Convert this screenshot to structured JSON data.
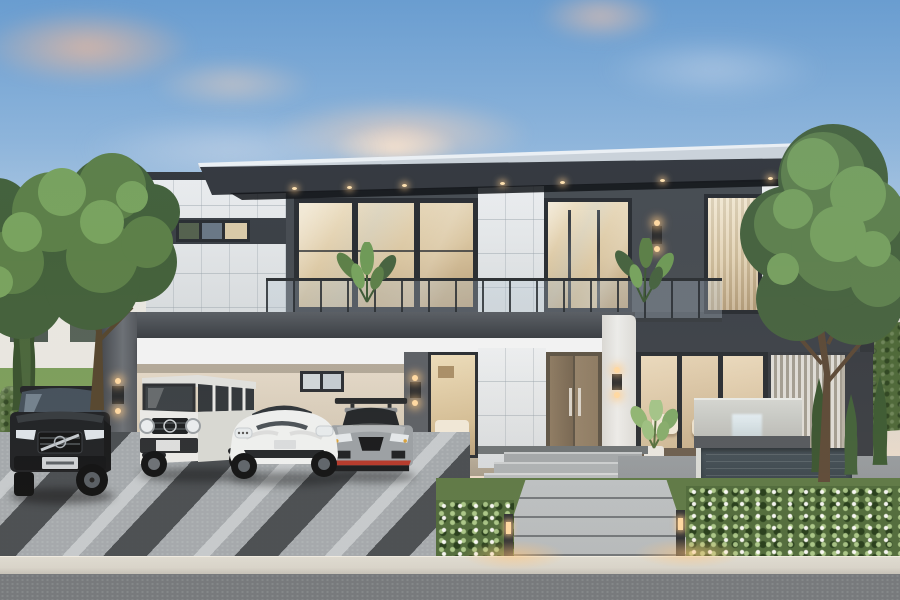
{
  "scene": {
    "setting": "Exterior rendering of a modern flat-roof two-storey luxury house at dusk",
    "elements": [
      "dusk sky with pink clouds",
      "large leafy trees flanking the house",
      "cantilevered dark roof with recessed soffit downlights",
      "white marble-tile feature tower with slot window",
      "full-height warm-lit windows and glass balcony with plants",
      "carport with dark frame and white beam",
      "wooden double entry door with steel pull handles",
      "glazed living room with cream sofas",
      "stone water-feature wall with reflecting pool",
      "clipped hedges, conical shrubs and raised lawn",
      "driveway with diagonal charcoal stripes",
      "stone paver walkway with bollard lights",
      "flower beds with white blossoms",
      "street strip in the foreground"
    ],
    "cars": [
      {
        "name": "black-luxury-suv",
        "body_color": "#1f2226"
      },
      {
        "name": "white-boxy-offroad-suv",
        "body_color": "#e9eae8"
      },
      {
        "name": "white-electric-sports-sedan",
        "body_color": "#eef0f0"
      },
      {
        "name": "grey-sports-coupe",
        "body_color": "#9aa0a5",
        "accent_color": "#b5382b"
      }
    ],
    "lighting": [
      "warm interior glow in every window",
      "soffit downlights under roof",
      "up/down wall sconces on pillars",
      "warm bollard path lights with glow pools on curb"
    ]
  },
  "palette": {
    "sky-top": "#6b9fd2",
    "sky-low": "#d2d4cf",
    "sky-horizon": "#eedccb",
    "cloud-pink": "#e8bca2",
    "cloud-cream": "#f4ddc6",
    "roof-metal": "#cdd4db",
    "roof-fascia": "#35393f",
    "soffit": "#24272c",
    "wall-dark": "#484d53",
    "wall-dark2": "#3e434a",
    "frame": "#2b2f34",
    "marble": "#e3e6e8",
    "warm-hi": "#f0e3c8",
    "warm-mid": "#d9c5a0",
    "warm-lo": "#b89e78",
    "beam-white": "#f2f3f4",
    "int-wall": "#e3d9c9",
    "int-wall2": "#c0b5a2",
    "door-wood": "#8d7b63",
    "door-wood2": "#776753",
    "hedge": "#4d6839",
    "lawn": "#7c9e5c",
    "tree-dark": "#44613c",
    "tree-mid": "#5d8049",
    "tree-hi": "#79a35f",
    "trunk": "#5c4a38",
    "drive": "#a2a8ad",
    "stripe-dark": "#3f4449",
    "stripe-light": "#c8cdd1",
    "road": "#72777c",
    "curb": "#d7d4cb",
    "stone": "#cfd1cd",
    "pool": "#36424a",
    "glow": "#ffd9a2",
    "sconce": "#26292d",
    "white-col": "#ececea",
    "slat": "#b7b2a6",
    "patio": "#8e9397",
    "walk": "#b4b9bc",
    "bed": "#5c7846"
  }
}
